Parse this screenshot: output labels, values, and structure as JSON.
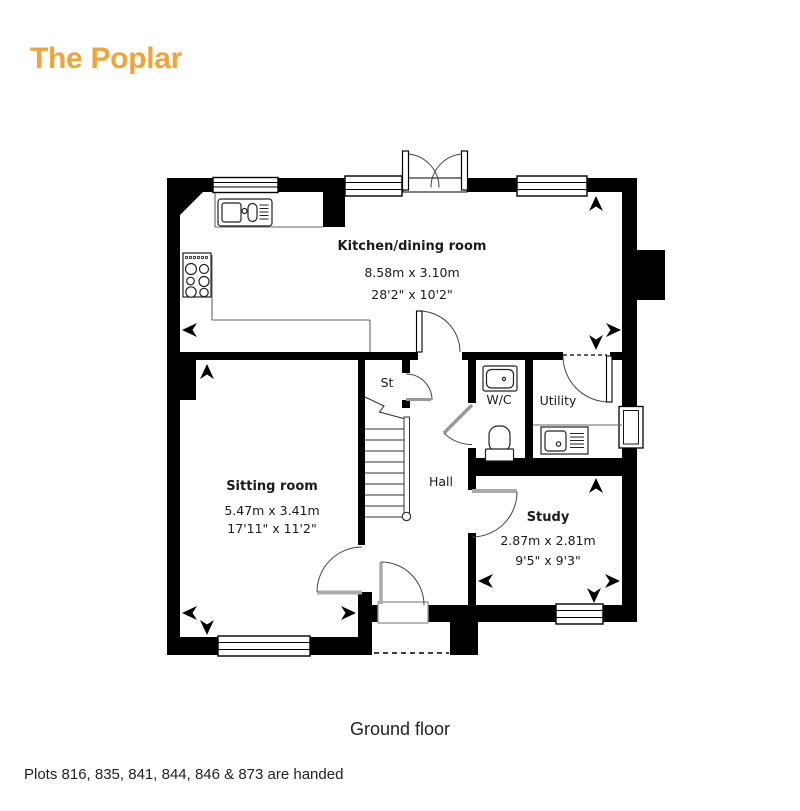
{
  "title": "The Poplar",
  "colors": {
    "accent": "#F0A437",
    "wall": "#000000"
  },
  "plan": {
    "kitchen": {
      "name": "Kitchen/dining room",
      "metric": "8.58m x 3.10m",
      "imperial": "28'2\" x 10'2\""
    },
    "sitting": {
      "name": "Sitting room",
      "metric": "5.47m x 3.41m",
      "imperial": "17'11\" x 11'2\""
    },
    "study": {
      "name": "Study",
      "metric": "2.87m x 2.81m",
      "imperial": "9'5\" x 9'3\""
    },
    "hall": {
      "name": "Hall"
    },
    "wc": {
      "name": "W/C"
    },
    "utility": {
      "name": "Utility"
    },
    "store": {
      "name": "St"
    }
  },
  "floor_label": "Ground floor",
  "footnote": "Plots 816, 835, 841, 844, 846 & 873 are handed"
}
